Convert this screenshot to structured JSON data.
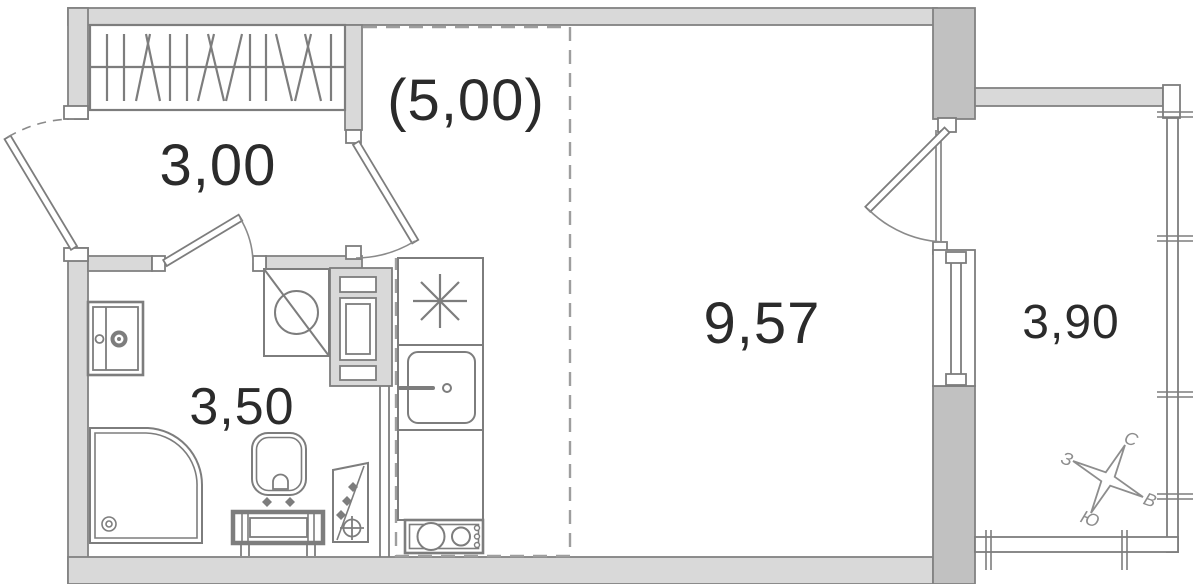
{
  "plan": {
    "type": "apartment-floor-plan",
    "rooms": [
      {
        "id": "hallway",
        "area": "3,00"
      },
      {
        "id": "kitchen-zone",
        "area": "(5,00)"
      },
      {
        "id": "living-room",
        "area": "9,57"
      },
      {
        "id": "bathroom",
        "area": "3,50"
      },
      {
        "id": "balcony",
        "area": "3,90"
      }
    ],
    "compass": {
      "north": "С",
      "east": "В",
      "south": "Ю",
      "west": "З"
    },
    "fixtures": [
      "wardrobe-icon",
      "entrance-door-icon",
      "interior-door-icon",
      "washbasin-cabinet-icon",
      "washing-machine-icon",
      "shower-tray-icon",
      "toilet-icon",
      "plumbing-riser-icon",
      "vent-shaft-icon",
      "fridge-snowflake-icon",
      "kitchen-sink-icon",
      "cooktop-icon",
      "balcony-glazing-icon",
      "compass-rose-icon"
    ],
    "colors": {
      "wall_fill": "#d9d9d9",
      "wall_dark": "#c1c1c1",
      "line": "#7d7d7d",
      "label": "#2b2b2b",
      "dashed_zone": "#9e9e9e",
      "compass": "#8d8d8d"
    }
  }
}
